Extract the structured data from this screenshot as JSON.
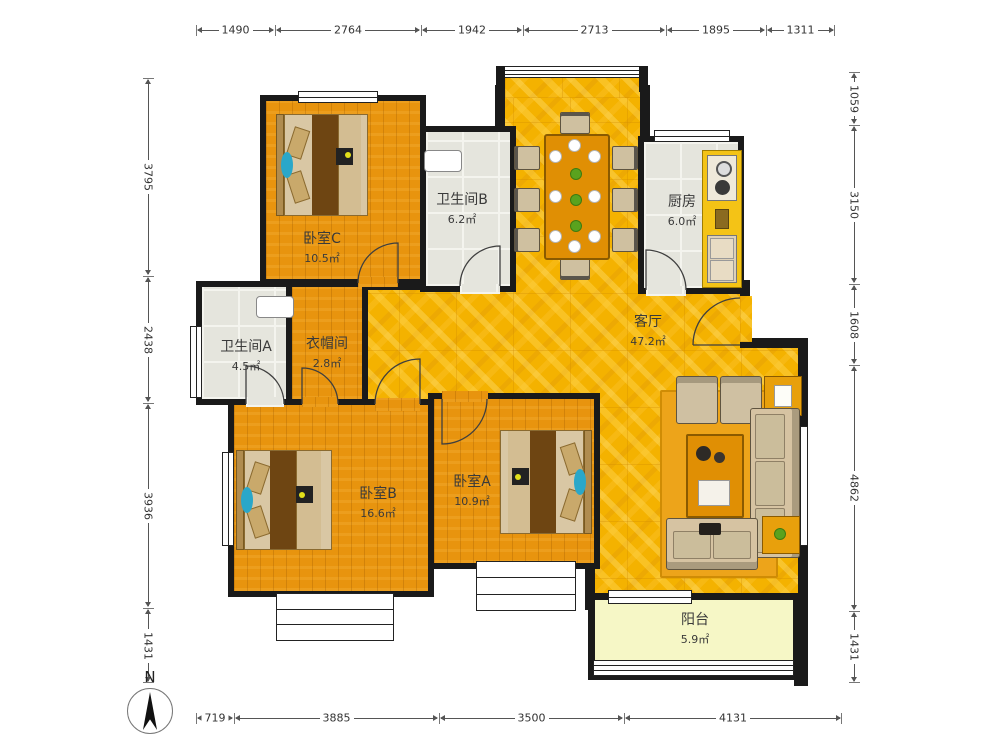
{
  "compass": {
    "label": "N"
  },
  "rooms": [
    {
      "id": "bedroom-c",
      "name": "卧室C",
      "area": "10.5㎡"
    },
    {
      "id": "bathroom-b",
      "name": "卫生间B",
      "area": "6.2㎡"
    },
    {
      "id": "kitchen",
      "name": "厨房",
      "area": "6.0㎡"
    },
    {
      "id": "bathroom-a",
      "name": "卫生间A",
      "area": "4.5㎡"
    },
    {
      "id": "cloakroom",
      "name": "衣帽间",
      "area": "2.8㎡"
    },
    {
      "id": "living-room",
      "name": "客厅",
      "area": "47.2㎡"
    },
    {
      "id": "bedroom-b",
      "name": "卧室B",
      "area": "16.6㎡"
    },
    {
      "id": "bedroom-a",
      "name": "卧室A",
      "area": "10.9㎡"
    },
    {
      "id": "balcony",
      "name": "阳台",
      "area": "5.9㎡"
    }
  ],
  "dimensions": {
    "top": [
      "1490",
      "2764",
      "1942",
      "2713",
      "1895",
      "1311"
    ],
    "bottom": [
      "719",
      "3885",
      "3500",
      "4131"
    ],
    "left": [
      "3795",
      "2438",
      "3936",
      "1431"
    ],
    "right": [
      "1059",
      "3150",
      "1608",
      "4862",
      "1431"
    ]
  },
  "palette": {
    "wall": "#1a1a1a",
    "wood_floor": "#e8940e",
    "living_floor": "#f4b200",
    "tile_floor": "#e5e5dd",
    "balcony_floor": "#f6f7c6",
    "accent_teal": "#2aa7c9",
    "counter_yellow": "#f4c316"
  }
}
